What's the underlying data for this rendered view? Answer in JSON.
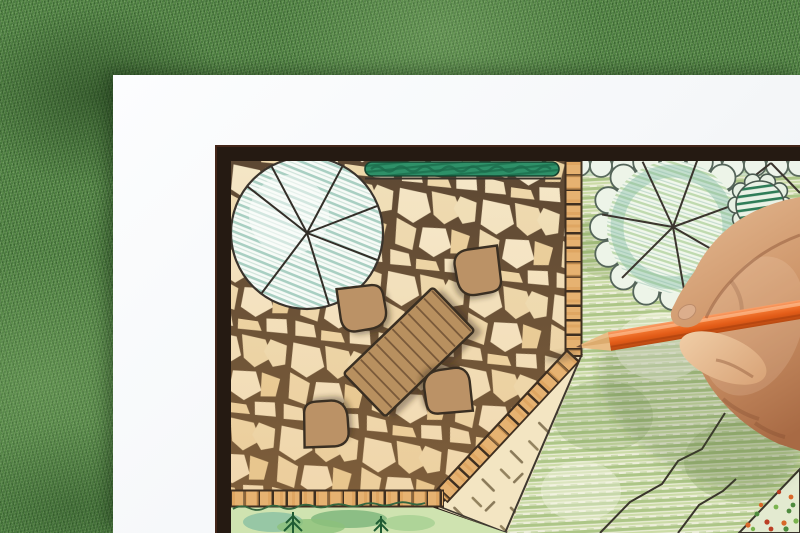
{
  "scene": {
    "type": "photograph",
    "description": "Overhead photo of a designer's hand drawing a colored landscape garden plan with an orange pencil. A white plan sheet with a dark frame border lies on green grass; the plan shows a flagstone patio with a wooden dining table and four chairs, round tree symbols, a hedge, crayon-shaded lawn, brick paver border bands, a cross-hatched paving area and watercolor planting beds.",
    "objects": [
      {
        "name": "grass-background",
        "label": "Green grass turf surface"
      },
      {
        "name": "paper-sheet",
        "label": "White drawing paper"
      },
      {
        "name": "plan-frame",
        "label": "Dark plan frame border"
      },
      {
        "name": "flagstone-patio",
        "label": "Irregular flagstone patio paving"
      },
      {
        "name": "shade-tree-symbol",
        "label": "Round shade tree symbol with radial branch lines and blue-green hatching"
      },
      {
        "name": "cloud-tree-symbol",
        "label": "Scalloped-canopy tree symbol over the lawn"
      },
      {
        "name": "hedge-symbol",
        "label": "Dark green hedge strip along top of patio"
      },
      {
        "name": "hatched-shrub",
        "label": "Dark green hatched evergreen shrub"
      },
      {
        "name": "dining-table",
        "label": "Rectangular wood-plank table, rotated diagonally"
      },
      {
        "name": "patio-chair",
        "label": "Rounded patio chair",
        "count": 4
      },
      {
        "name": "brick-border",
        "label": "Brick paver edging band (vertical, diagonal and horizontal runs)"
      },
      {
        "name": "gravel-area",
        "label": "Tan paving area with cross-hatch tick marks"
      },
      {
        "name": "lawn-area",
        "label": "Green crayon-shaded lawn"
      },
      {
        "name": "planting-bed",
        "label": "Watercolor planting bed with conifer symbols"
      },
      {
        "name": "flower-bed",
        "label": "Corner flower bed with colored dots"
      },
      {
        "name": "pencil",
        "label": "Orange colored pencil, tip touching the plan"
      },
      {
        "name": "hand",
        "label": "Right hand gripping the pencil from the right edge"
      }
    ],
    "colors": {
      "grass": "#4b7c3f",
      "paper": "#f7f8fa",
      "frame": "#251a12",
      "stone": "#f2e3c2",
      "grout": "#5d4833",
      "brick": "#e6b271",
      "wood_furniture": "#b8905f",
      "outline": "#3a2f22",
      "hedge": "#2e9068",
      "tree_hatch_blue": "#a9cfc2",
      "lawn_green": "#adc687",
      "pencil_orange": "#e86220",
      "skin": "#cd9468"
    }
  }
}
